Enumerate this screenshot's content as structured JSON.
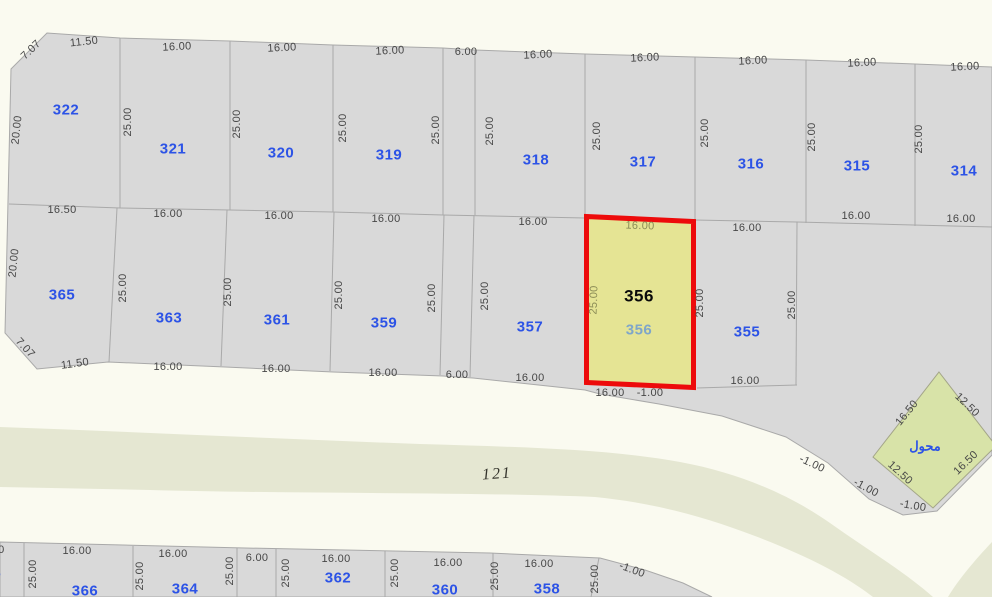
{
  "map_type": "cadastral-parcel-map",
  "colors": {
    "background": "#FAFAF0",
    "parcel_fill": "#D9D9D9",
    "parcel_boundary": "#A9A9A9",
    "road_fill": "#E5E7D2",
    "highlight_fill": "#E5E494",
    "highlight_border": "#ED0B0B",
    "parcel_number_blue": "#2C53E6",
    "dim_text": "#474747",
    "dim_text_olive": "#8B8C57",
    "secondary_number_steel": "#7FA6C9"
  },
  "rows": {
    "top": {
      "numbers": [
        "322",
        "321",
        "320",
        "319",
        "318",
        "317",
        "316",
        "315",
        "314"
      ],
      "edge_top": [
        "7.07",
        "11.50",
        "16.00",
        "16.00",
        "16.00",
        "6.00",
        "16.00",
        "16.00",
        "16.00",
        "16.00",
        "16.00"
      ],
      "edge_side": [
        "20.00",
        "25.00",
        "25.00",
        "25.00",
        "25.00",
        "25.00",
        "25.00",
        "25.00",
        "25.00",
        "25.00"
      ],
      "edge_bottom": [
        "16.50",
        "16.00",
        "16.00",
        "16.00",
        "16.00",
        "16.00",
        "16.00",
        "16.00"
      ]
    },
    "middle": {
      "numbers": [
        "365",
        "363",
        "361",
        "359",
        "357",
        "355"
      ],
      "edge_side": [
        "20.00",
        "25.00",
        "25.00",
        "25.00",
        "25.00",
        "25.00",
        "25.00",
        "25.00"
      ],
      "edge_bottom": [
        "7.07",
        "11.50",
        "16.00",
        "16.00",
        "16.00",
        "6.00",
        "16.00",
        "16.00"
      ]
    },
    "bottom": {
      "numbers": [
        "368",
        "366",
        "364",
        "362",
        "360",
        "358"
      ],
      "edge_top": [
        "16.00",
        "16.00",
        "16.00",
        "6.00",
        "16.00",
        "16.00",
        "16.00"
      ],
      "edge_side": [
        "25.00",
        "25.00",
        "25.00",
        "25.00",
        "25.00",
        "25.00",
        "25.00"
      ],
      "offset_dim": "-1.00"
    }
  },
  "highlight": {
    "number": "356",
    "secondary_number": "356",
    "top_dim": "16.00",
    "side_dim": "25.00",
    "bottom_dim": "16.00",
    "offset_dim": "-1.00"
  },
  "curve_offset_dims": [
    "-1.00",
    "-1.00",
    "-1.00"
  ],
  "transformer": {
    "label": "محول",
    "dim_top_left": "16.50",
    "dim_top_right": "12.50",
    "dim_bottom_left": "12.50",
    "dim_bottom_right": "16.50"
  },
  "road": {
    "number": "121"
  }
}
